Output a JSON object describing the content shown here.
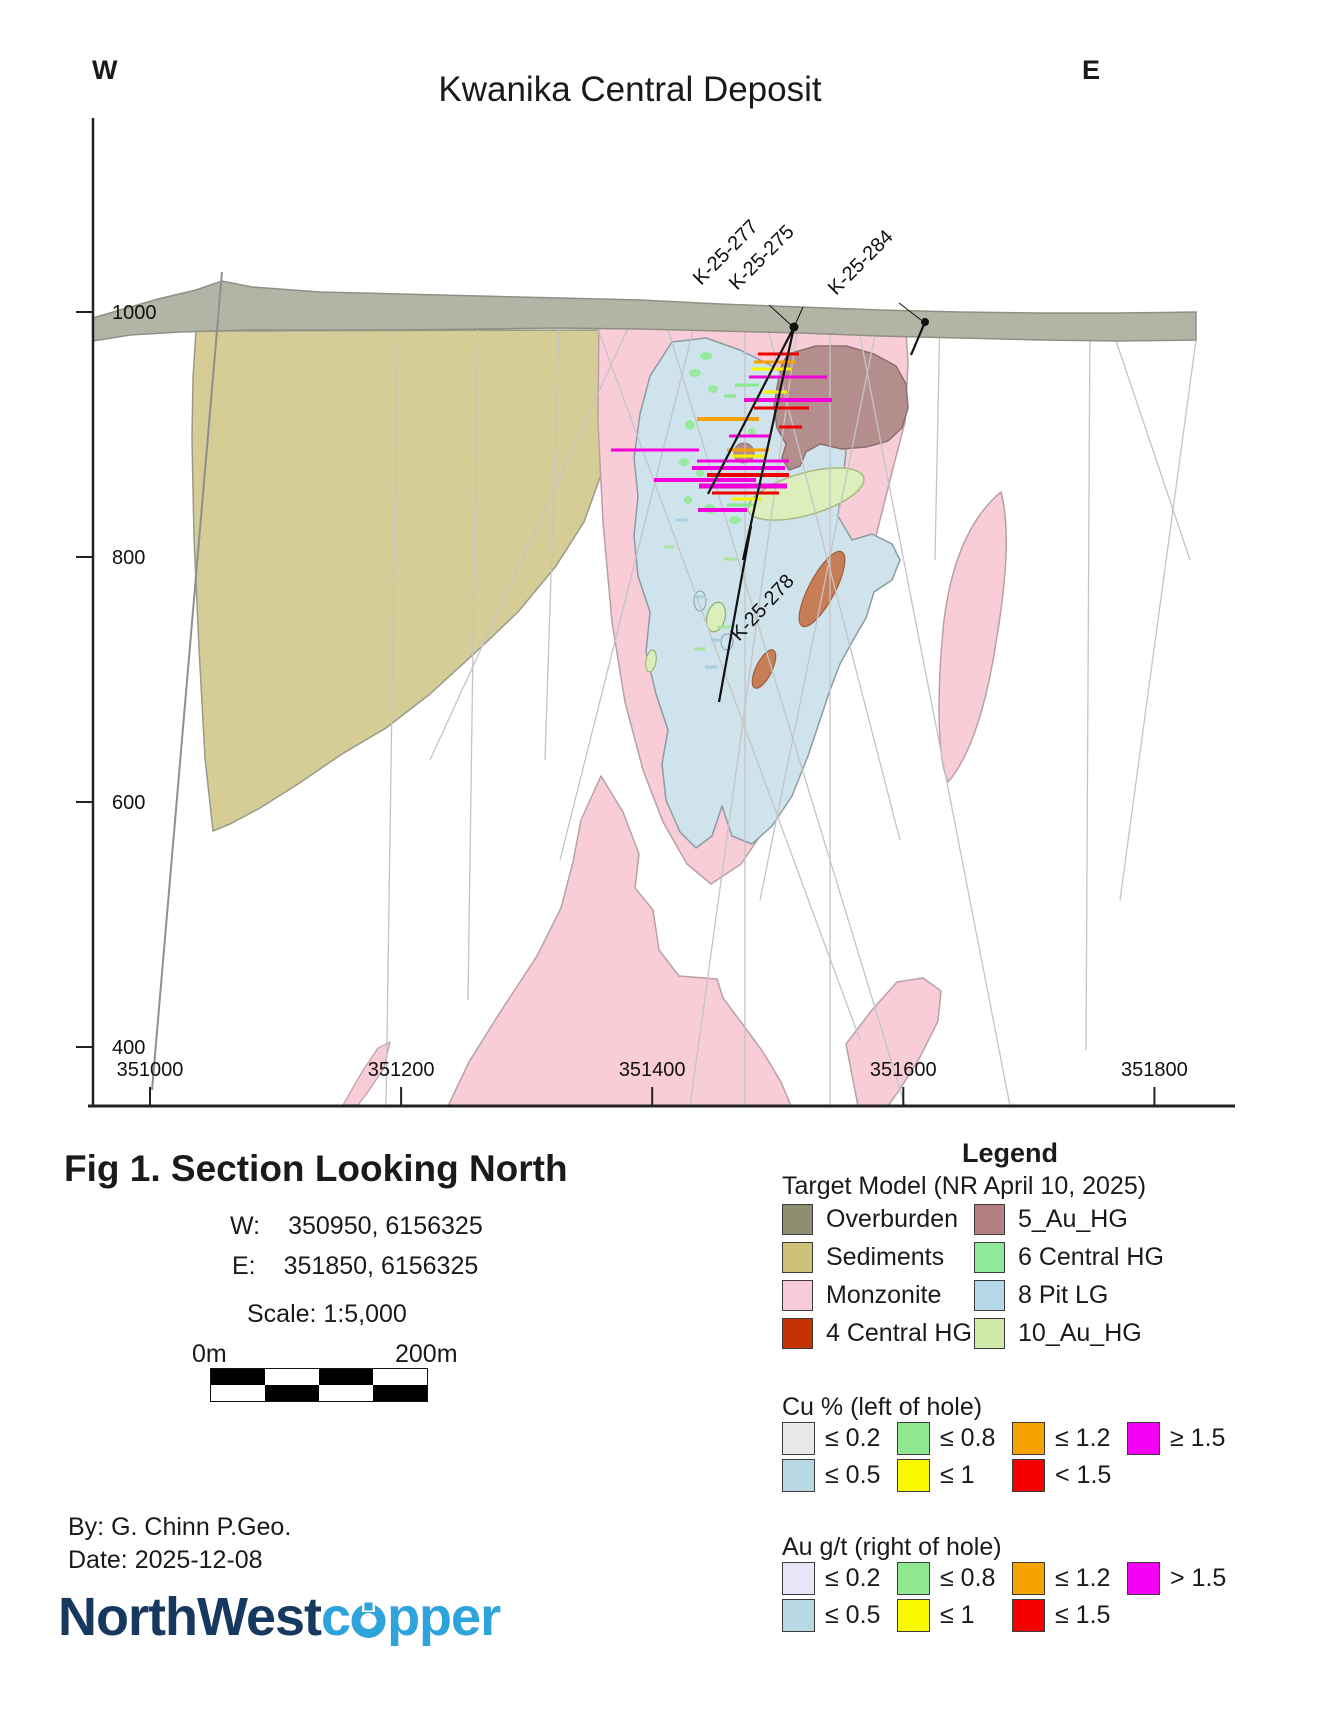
{
  "page": {
    "title": "Kwanika Central Deposit",
    "west_corner": "W",
    "east_corner": "E"
  },
  "axes": {
    "elevation_ticks": [
      1000,
      800,
      600,
      400
    ],
    "easting_ticks": [
      351000,
      351200,
      351400,
      351600,
      351800
    ]
  },
  "drillholes": {
    "labels": [
      {
        "id": "K-25-277"
      },
      {
        "id": "K-25-275"
      },
      {
        "id": "K-25-284"
      },
      {
        "id": "K-25-278"
      }
    ]
  },
  "interval_palette": {
    "M": "#f400dc",
    "R": "#f20000",
    "O": "#f8a200",
    "Y": "#f6f200",
    "G": "#8ce88c",
    "LG": "#a8e6a0",
    "LB": "#a8cfe2"
  },
  "intervals": [
    [
      758,
      354,
      799,
      "R",
      3
    ],
    [
      754,
      362,
      796,
      "O",
      3
    ],
    [
      752,
      369,
      791,
      "Y",
      3
    ],
    [
      749,
      377,
      827,
      "M",
      3
    ],
    [
      735,
      385,
      759,
      "G",
      3
    ],
    [
      764,
      392,
      787,
      "Y",
      3
    ],
    [
      744,
      400,
      832,
      "M",
      4
    ],
    [
      754,
      408,
      809,
      "R",
      3
    ],
    [
      724,
      396,
      736,
      "G",
      3
    ],
    [
      697,
      419,
      759,
      "O",
      4
    ],
    [
      779,
      427,
      802,
      "R",
      3
    ],
    [
      729,
      436,
      771,
      "M",
      3
    ],
    [
      611,
      450,
      699,
      "M",
      3
    ],
    [
      727,
      450,
      769,
      "O",
      3
    ],
    [
      732,
      456,
      765,
      "Y",
      3
    ],
    [
      697,
      461,
      789,
      "M",
      3
    ],
    [
      692,
      468,
      785,
      "M",
      4
    ],
    [
      707,
      475,
      789,
      "R",
      4
    ],
    [
      654,
      480,
      756,
      "M",
      4
    ],
    [
      699,
      486,
      787,
      "M",
      5
    ],
    [
      712,
      493,
      779,
      "R",
      3
    ],
    [
      732,
      499,
      762,
      "Y",
      3
    ],
    [
      727,
      505,
      755,
      "G",
      3
    ],
    [
      698,
      510,
      747,
      "M",
      4
    ],
    [
      676,
      520,
      688,
      "LB",
      3
    ],
    [
      664,
      547,
      674,
      "LG",
      3
    ],
    [
      724,
      559,
      737,
      "LG",
      3
    ],
    [
      696,
      597,
      706,
      "LB",
      3
    ],
    [
      717,
      627,
      731,
      "LG",
      3
    ],
    [
      711,
      640,
      723,
      "LB",
      3
    ],
    [
      694,
      649,
      705,
      "LG",
      3
    ],
    [
      705,
      667,
      717,
      "LB",
      3
    ]
  ],
  "figure": {
    "caption": "Fig 1. Section Looking North",
    "w_label": "W:",
    "w_value": "350950, 6156325",
    "e_label": "E:",
    "e_value": "351850, 6156325",
    "scale": "Scale: 1:5,000",
    "bar_left": "0m",
    "bar_right": "200m",
    "by": "By: G. Chinn P.Geo.",
    "date": "Date: 2025-12-08"
  },
  "legend": {
    "title": "Legend",
    "target_model": {
      "title": "Target Model (NR April 10, 2025)",
      "items": [
        {
          "label": "Overburden",
          "color": "#8e8e70"
        },
        {
          "label": "5_Au_HG",
          "color": "#b28080"
        },
        {
          "label": "Sediments",
          "color": "#cec279"
        },
        {
          "label": "6 Central HG",
          "color": "#8fe99b"
        },
        {
          "label": "Monzonite",
          "color": "#f8c9d6"
        },
        {
          "label": "8 Pit LG",
          "color": "#b5d8e9"
        },
        {
          "label": "4 Central HG",
          "color": "#c53305"
        },
        {
          "label": "10_Au_HG",
          "color": "#cfe9a8"
        }
      ]
    },
    "cu": {
      "title": "Cu % (left of hole)",
      "rows": [
        [
          {
            "label": "≤ 0.2",
            "color": "#e9e9e9"
          },
          {
            "label": "≤ 0.8",
            "color": "#90e890"
          },
          {
            "label": "≤ 1.2",
            "color": "#f8a200"
          },
          {
            "label": "≥ 1.5",
            "color": "#f400f4"
          }
        ],
        [
          {
            "label": "≤ 0.5",
            "color": "#b8d9e3"
          },
          {
            "label": "≤ 1",
            "color": "#fbf800"
          },
          {
            "label": "< 1.5",
            "color": "#f60000"
          }
        ]
      ]
    },
    "au": {
      "title": "Au g/t (right of hole)",
      "rows": [
        [
          {
            "label": "≤ 0.2",
            "color": "#e6e6f8"
          },
          {
            "label": "≤ 0.8",
            "color": "#90e890"
          },
          {
            "label": "≤ 1.2",
            "color": "#f8a200"
          },
          {
            "label": "> 1.5",
            "color": "#f400f4"
          }
        ],
        [
          {
            "label": "≤ 0.5",
            "color": "#b8d9e3"
          },
          {
            "label": "≤ 1",
            "color": "#fbf800"
          },
          {
            "label": "≤ 1.5",
            "color": "#f60000"
          }
        ]
      ]
    }
  },
  "logo": {
    "part1": "NorthWest",
    "part2_start": "c",
    "part2_end": "pper"
  }
}
